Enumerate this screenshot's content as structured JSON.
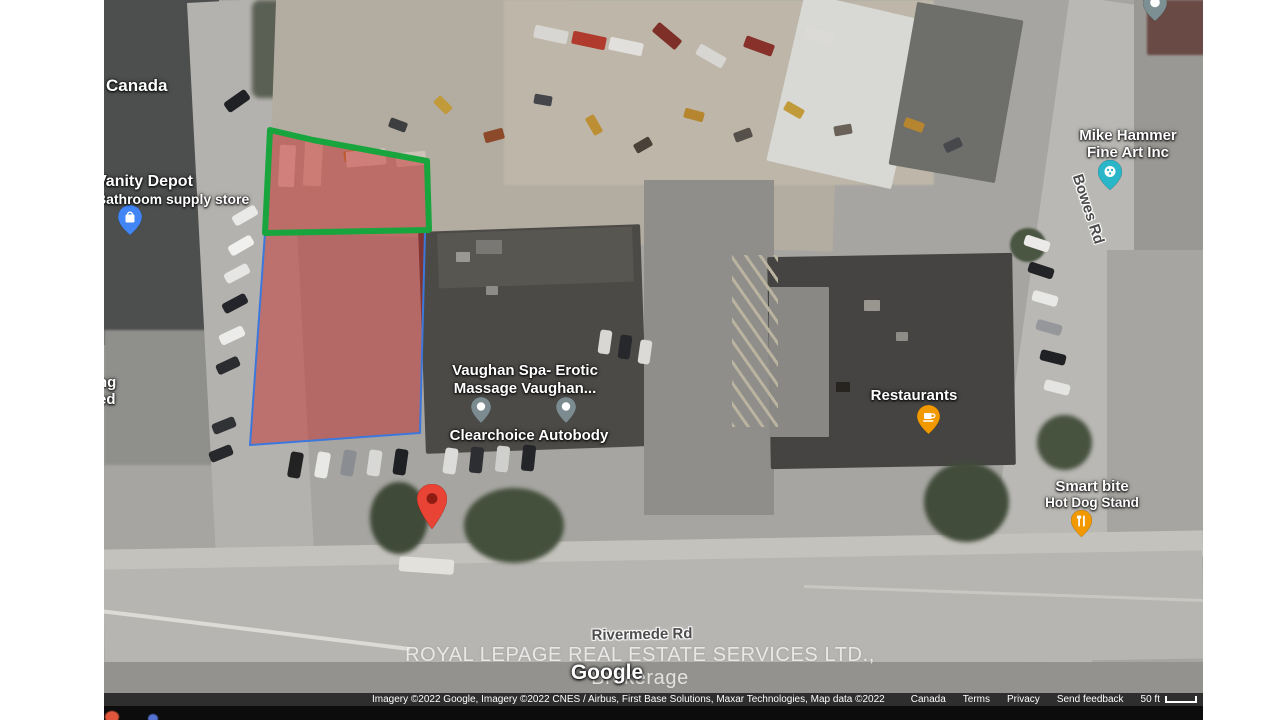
{
  "labels": {
    "canada": "Canada",
    "vanity_depot_line1": "Vanity Depot",
    "vanity_depot_line2": "Bathroom supply store",
    "left_partial_line1": "ng",
    "left_partial_line2": "ed",
    "mike_hammer_line1": "Mike Hammer",
    "mike_hammer_line2": "Fine Art Inc",
    "bowes_rd": "Bowes Rd",
    "vaughan_spa_line1": "Vaughan Spa- Erotic",
    "vaughan_spa_line2": "Massage Vaughan...",
    "clearchoice": "Clearchoice Autobody",
    "restaurants": "Restaurants",
    "smart_bite_line1": "Smart bite",
    "smart_bite_line2": "Hot Dog Stand",
    "rivermede_rd": "Rivermede Rd"
  },
  "watermark": "ROYAL LEPAGE REAL ESTATE SERVICES LTD., Brokerage",
  "google_logo": "Google",
  "overlays": {
    "highlight_fill": "rgba(201,30,30,0.44)",
    "green_outline": "#18A53D",
    "blue_outline": "#3C78DC",
    "marker_red": "#E94335"
  },
  "attribution": {
    "imagery_credit": "Imagery ©2022 Google, Imagery ©2022 CNES / Airbus, First Base Solutions, Maxar Technologies, Map data ©2022",
    "region_link": "Canada",
    "terms_link": "Terms",
    "privacy_link": "Privacy",
    "feedback_link": "Send feedback",
    "scale_label": "50 ft"
  }
}
